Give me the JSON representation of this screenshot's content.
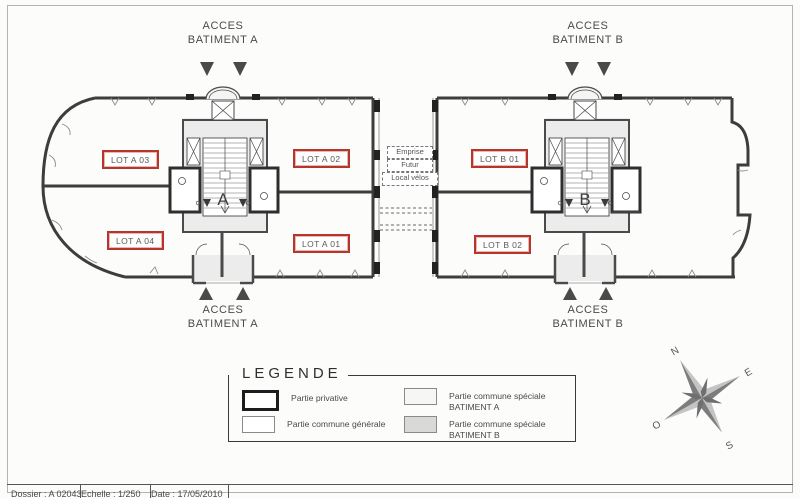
{
  "access": {
    "acces": "ACCES",
    "batiment_a": "BATIMENT A",
    "batiment_b": "BATIMENT B"
  },
  "lots": {
    "a03": "LOT A 03",
    "a02": "LOT A 02",
    "a04": "LOT A 04",
    "a01": "LOT A 01",
    "b01": "LOT B 01",
    "b02": "LOT B 02"
  },
  "corridor": {
    "emprise": "Emprise",
    "futur": "Futur",
    "local_velos": "Local vélos"
  },
  "buildings": {
    "a": "A",
    "b": "B"
  },
  "legend": {
    "title": "LEGENDE",
    "items": [
      {
        "label": "Partie privative",
        "sublabel": ""
      },
      {
        "label": "Partie commune générale",
        "sublabel": ""
      },
      {
        "label": "Partie commune spéciale",
        "sublabel": "BATIMENT A"
      },
      {
        "label": "Partie commune spéciale",
        "sublabel": "BATIMENT B"
      }
    ]
  },
  "compass": {
    "n": "N",
    "e": "E",
    "s": "S",
    "o": "O"
  },
  "footer": {
    "cells": [
      "Dossier : A 02043",
      "Echelle : 1/250",
      "Date : 17/05/2010"
    ]
  },
  "colors": {
    "lot_border": "#b5362c",
    "wall": "#3d3d3d",
    "common_fill": "#ececec",
    "speciale_b_fill": "#d9d9d7"
  }
}
